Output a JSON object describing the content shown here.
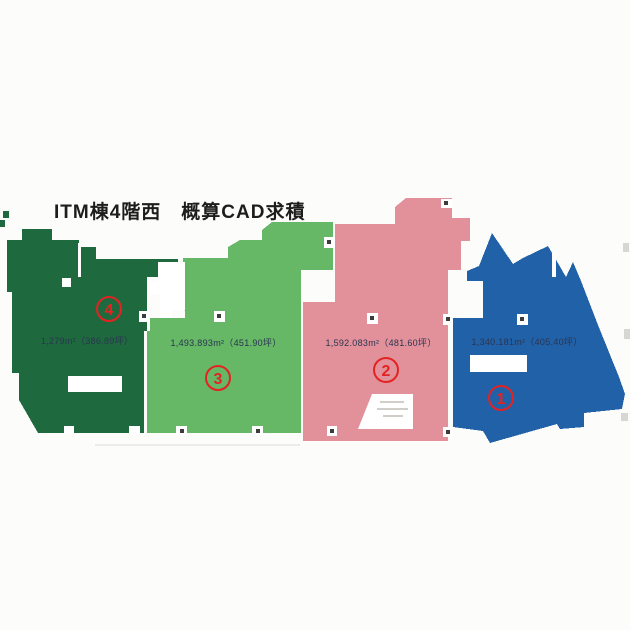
{
  "title": "ITM棟4階西　概算CAD求積",
  "colors": {
    "background": "#fcfcfa",
    "marker_red": "#e32322",
    "area_text": "#2a3550",
    "title_text": "#1d1d1b",
    "region1_blue": "#2161a8",
    "region2_pink": "#e2909a",
    "region3_light_green": "#66b766",
    "region4_dark_green": "#1e6a3e"
  },
  "regions": [
    {
      "digit": "1",
      "circled": "①",
      "area_text": "1,340.181m²（405.40坪）",
      "color": "#2161a8",
      "color_name": "blue"
    },
    {
      "digit": "2",
      "circled": "②",
      "area_text": "1,592.083m²（481.60坪）",
      "color": "#e2909a",
      "color_name": "pink"
    },
    {
      "digit": "3",
      "circled": "③",
      "area_text": "1,493.893m²（451.90坪）",
      "color": "#66b766",
      "color_name": "light-green"
    },
    {
      "digit": "4",
      "circled": "④",
      "area_text": "1,279m²（386.89坪）",
      "color": "#1e6a3e",
      "color_name": "dark-green"
    }
  ]
}
